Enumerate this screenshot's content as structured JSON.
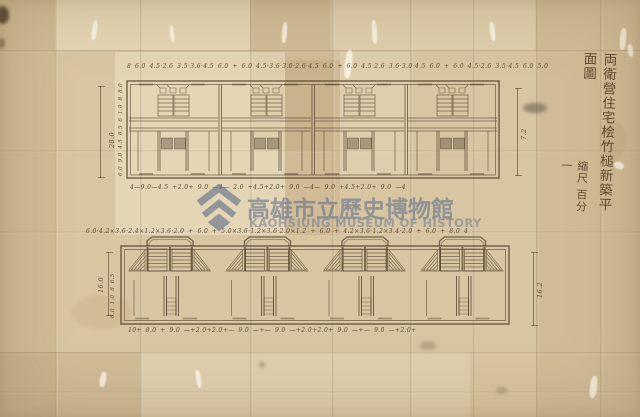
{
  "document": {
    "kind": "scanned hand-drawn architectural floor-plan on aged folded paper",
    "paper_color": "#d8c5a1",
    "ink_color": "#4c3c27"
  },
  "watermark": {
    "name_zh": "高雄市立歷史博物館",
    "name_en": "KAOHSIUNG MUSEUM OF HISTORY",
    "color": "rgba(100,115,140,0.62)",
    "color_en": "rgba(108,122,146,0.55)",
    "logo": "chevron-diamond-mark"
  },
  "title_block": {
    "title": "両衛營住宅桧竹槌新築平面圖",
    "scale": "縮尺 百分一"
  },
  "upper_plan": {
    "dim_top": "8 6.0 4.5·2.6 3.5·3.6·4.5 6.0 + 6.0 4.5·3.6·3.0·2.6·4.5 6.0 + 6.0 4.5·2.6 3.6·3.0·4.5 6.0 + 6.0 4.5·2.6 3.5·4.5 6.0 5.0",
    "dim_bottom": "4—9.0—4.5 +2.0+ 9.0 —4— 2.0 +4.5+2.0+ 9.0 —4— 9.0 +4.5+2.0+ 9.0 —4",
    "dim_left_total": "28.0",
    "dim_left_segments": "6.0 9.0 4.5 8.5 6 1.0 8 8.0",
    "dim_right": "7.2"
  },
  "lower_plan": {
    "dim_top": "6.0·4.2×3.6·2.4×1.2×3.6·2.0 + 6.0 + 5.0×3.6·1.2×3.6·2.0×1.2 + 6.0 + 4.2×3.6·1.2×3.4·2.0 + 6.0 + 8.0 4",
    "dim_bottom": "10+ 8.0 + 9.0 —+2.0+2.0+— 9.0 —+— 9.0 —+2.0+2.0+ 9.0 —+— 9.0 —+2.0+",
    "dim_left_total": "16.0",
    "dim_left_segments": "6.0 1.0 8 6.5",
    "dim_right": "16.2"
  }
}
